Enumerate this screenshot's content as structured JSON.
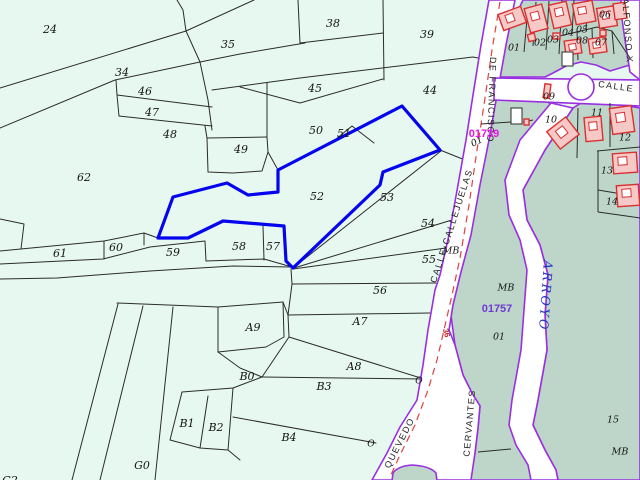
{
  "app": {
    "view": "cadastral-parcel-map",
    "selected_parcel": {
      "number": "52",
      "outline_color": "#0404ee"
    }
  },
  "colors": {
    "rural_background": "#e7f8f1",
    "urban_block": "#bdd6c9",
    "road_fill": "#ffffff",
    "road_edge_purple": "#9a2fe0",
    "road_centerline_red": "#e04040",
    "building_outline": "#d93030",
    "parcel_line": "#2b2b2b",
    "selected_blue": "#0404ee",
    "zone_code_magenta": "#e617e6",
    "zone_code_violet": "#6d3ad1",
    "stream_text_blue": "#2433c0"
  },
  "map": {
    "labels": [
      {
        "t": "24",
        "x": 50,
        "y": 30,
        "c": "parcel"
      },
      {
        "t": "34",
        "x": 122,
        "y": 73,
        "c": "parcel"
      },
      {
        "t": "35",
        "x": 228,
        "y": 45,
        "c": "parcel"
      },
      {
        "t": "38",
        "x": 333,
        "y": 24,
        "c": "parcel"
      },
      {
        "t": "39",
        "x": 427,
        "y": 35,
        "c": "parcel"
      },
      {
        "t": "45",
        "x": 315,
        "y": 89,
        "c": "parcel"
      },
      {
        "t": "44",
        "x": 430,
        "y": 91,
        "c": "parcel"
      },
      {
        "t": "46",
        "x": 145,
        "y": 92,
        "c": "parcel"
      },
      {
        "t": "47",
        "x": 152,
        "y": 113,
        "c": "parcel"
      },
      {
        "t": "48",
        "x": 170,
        "y": 135,
        "c": "parcel"
      },
      {
        "t": "49",
        "x": 241,
        "y": 150,
        "c": "parcel"
      },
      {
        "t": "50",
        "x": 316,
        "y": 131,
        "c": "parcel"
      },
      {
        "t": "51",
        "x": 344,
        "y": 134,
        "c": "parcel"
      },
      {
        "t": "52",
        "x": 317,
        "y": 197,
        "c": "parcel"
      },
      {
        "t": "53",
        "x": 387,
        "y": 198,
        "c": "parcel"
      },
      {
        "t": "54",
        "x": 428,
        "y": 224,
        "c": "parcel"
      },
      {
        "t": "55",
        "x": 429,
        "y": 260,
        "c": "parcel"
      },
      {
        "t": "MB",
        "x": 451,
        "y": 251,
        "c": "urban"
      },
      {
        "t": "56",
        "x": 380,
        "y": 291,
        "c": "parcel"
      },
      {
        "t": "57",
        "x": 273,
        "y": 247,
        "c": "parcel"
      },
      {
        "t": "58",
        "x": 239,
        "y": 247,
        "c": "parcel"
      },
      {
        "t": "59",
        "x": 173,
        "y": 253,
        "c": "parcel"
      },
      {
        "t": "60",
        "x": 116,
        "y": 248,
        "c": "parcel"
      },
      {
        "t": "61",
        "x": 60,
        "y": 254,
        "c": "parcel"
      },
      {
        "t": "62",
        "x": 84,
        "y": 178,
        "c": "parcel"
      },
      {
        "t": "A9",
        "x": 253,
        "y": 328,
        "c": "parcel"
      },
      {
        "t": "A7",
        "x": 360,
        "y": 322,
        "c": "parcel"
      },
      {
        "t": "A8",
        "x": 354,
        "y": 367,
        "c": "parcel"
      },
      {
        "t": "B0",
        "x": 247,
        "y": 377,
        "c": "parcel"
      },
      {
        "t": "B3",
        "x": 324,
        "y": 387,
        "c": "parcel"
      },
      {
        "t": "B4",
        "x": 289,
        "y": 438,
        "c": "parcel"
      },
      {
        "t": "B1",
        "x": 187,
        "y": 424,
        "c": "parcel"
      },
      {
        "t": "B2",
        "x": 216,
        "y": 428,
        "c": "parcel"
      },
      {
        "t": "G0",
        "x": 142,
        "y": 466,
        "c": "parcel"
      },
      {
        "t": "G2",
        "x": 10,
        "y": 481,
        "c": "parcel"
      },
      {
        "t": "O",
        "x": 419,
        "y": 381,
        "c": "o"
      },
      {
        "t": "O",
        "x": 371,
        "y": 444,
        "c": "o"
      },
      {
        "t": "01",
        "x": 514,
        "y": 48,
        "c": "urban"
      },
      {
        "t": "02",
        "x": 540,
        "y": 43,
        "c": "urban"
      },
      {
        "t": "03",
        "x": 553,
        "y": 40,
        "c": "urban"
      },
      {
        "t": "04",
        "x": 568,
        "y": 33,
        "c": "urban"
      },
      {
        "t": "05",
        "x": 582,
        "y": 30,
        "c": "urban"
      },
      {
        "t": "06",
        "x": 605,
        "y": 15,
        "c": "urban"
      },
      {
        "t": "08",
        "x": 582,
        "y": 41,
        "c": "urban"
      },
      {
        "t": "07",
        "x": 601,
        "y": 43,
        "c": "urban"
      },
      {
        "t": "09",
        "x": 549,
        "y": 97,
        "c": "urban"
      },
      {
        "t": "10",
        "x": 551,
        "y": 120,
        "c": "urban"
      },
      {
        "t": "11",
        "x": 597,
        "y": 113,
        "c": "urban"
      },
      {
        "t": "12",
        "x": 625,
        "y": 138,
        "c": "urban"
      },
      {
        "t": "13",
        "x": 607,
        "y": 171,
        "c": "urban"
      },
      {
        "t": "14",
        "x": 612,
        "y": 202,
        "c": "urban"
      },
      {
        "t": "15",
        "x": 613,
        "y": 420,
        "c": "urban"
      },
      {
        "t": "MB",
        "x": 506,
        "y": 288,
        "c": "urban"
      },
      {
        "t": "MB",
        "x": 620,
        "y": 452,
        "c": "urban"
      },
      {
        "t": "01",
        "x": 499,
        "y": 337,
        "c": "urban"
      },
      {
        "t": "01",
        "x": 477,
        "y": 142,
        "r": -25,
        "c": "urban"
      },
      {
        "t": "DE FRANCISCO",
        "x": 491,
        "y": 100,
        "r": 92,
        "c": "street"
      },
      {
        "t": "CALLE CALLEJUELAS",
        "x": 452,
        "y": 226,
        "r": -72,
        "c": "street"
      },
      {
        "t": "QUEVEDO",
        "x": 400,
        "y": 443,
        "r": -63,
        "c": "street"
      },
      {
        "t": "CERVANTES",
        "x": 470,
        "y": 423,
        "r": -85,
        "c": "street"
      },
      {
        "t": "ALFONSO X",
        "x": 627,
        "y": 31,
        "r": 86,
        "c": "street"
      },
      {
        "t": "CALLE",
        "x": 616,
        "y": 87,
        "r": 8,
        "c": "street"
      },
      {
        "t": "ARROYO",
        "x": 545,
        "y": 296,
        "r": 94,
        "c": "arroyo"
      },
      {
        "t": "01739",
        "x": 484,
        "y": 134,
        "c": "zonem"
      },
      {
        "t": "01757",
        "x": 497,
        "y": 309,
        "c": "zonev"
      },
      {
        "t": "36",
        "x": 446,
        "y": 333,
        "r": 75,
        "c": "roadred"
      }
    ]
  }
}
